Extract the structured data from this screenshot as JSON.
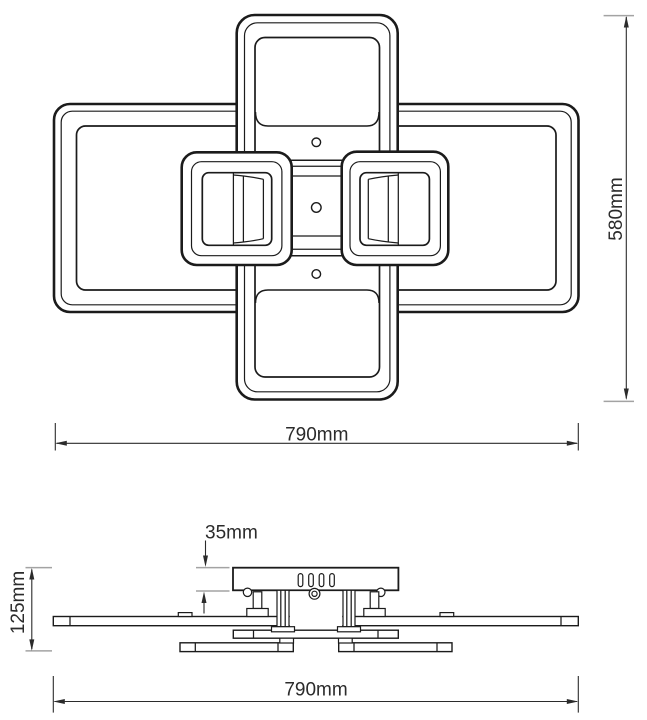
{
  "labels": {
    "top_width": "790mm",
    "overall_height": "580mm",
    "canopy_height": "35mm",
    "overall_depth": "125mm",
    "side_width": "790mm"
  },
  "colors": {
    "background": "#ffffff",
    "line": "#1b1b1b",
    "dimension": "#2b2b2b",
    "extension": "#a3a3a3"
  }
}
